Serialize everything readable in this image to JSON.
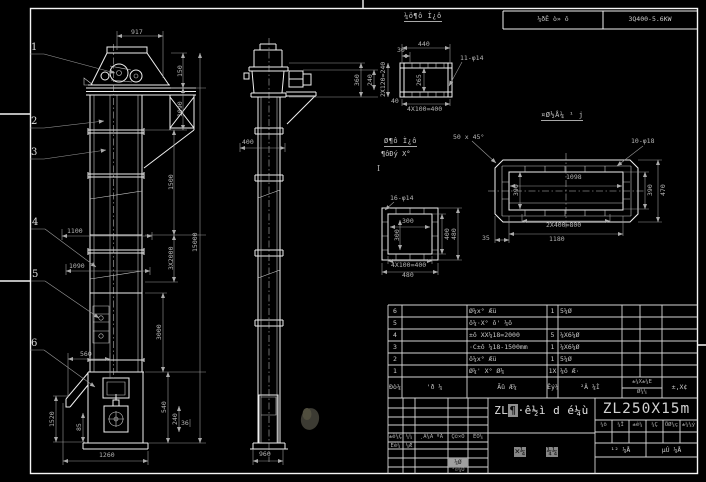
{
  "top_bar": {
    "material_note": "¼ðÊ ò» ô",
    "power_note": "3Q400-5.6KW"
  },
  "front_view": {
    "balloons": [
      "1",
      "2",
      "3",
      "4",
      "5",
      "6"
    ],
    "d917": "917",
    "d150": "150",
    "d1090": "1090",
    "d1500": "1500",
    "d3x2000": "3X2000",
    "d15000": "15000",
    "d3000": "3000",
    "d540": "540",
    "d240": "240",
    "d36": "36",
    "d1100": "1100",
    "d1090b": "1090",
    "d560": "560",
    "d1520": "1520",
    "d85": "85",
    "d1260": "1260"
  },
  "side_view": {
    "d400": "400",
    "d950": "960",
    "d360": "360",
    "d240": "240",
    "mark": "I"
  },
  "details": {
    "channel": {
      "title": "¼ö¶ô Ì¿ô",
      "d440": "440",
      "d30": "30",
      "holes": "11-φ14",
      "d265": "265",
      "dleft": "2X120=240",
      "d40": "40",
      "dbot": "4X100=400"
    },
    "section_note": {
      "line1": "Ø¶ô Ì¿ô",
      "line2": "¶ôÐý X°"
    },
    "square": {
      "holes": "16-φ14",
      "d300h": "300",
      "d300v": "300",
      "dbot1": "4X100=400",
      "dbot2": "480",
      "dr400": "400",
      "dr480": "480"
    },
    "flange": {
      "title": "¤Ø½Å¼ ¹ j",
      "chamfer": "50 x 45°",
      "holes": "10-φ18",
      "d1098": "1098",
      "d390l": "390",
      "dbot1": "2X400=800",
      "dbot2": "1180",
      "d35": "35",
      "d390r": "390",
      "d470": "470"
    }
  },
  "bom": {
    "header": {
      "no": "Ðò¼",
      "code": "'ð ¼",
      "name": "Ãû Æ¼",
      "qty": "Êý¼",
      "mat": "²Ä ¼Ì",
      "wtop": "±¼X±¼E",
      "wbot": "Ø¼¼",
      "rem": "±,X¢"
    },
    "rows": [
      {
        "no": "6",
        "name": "Ø¼x° Æü",
        "qty": "1",
        "mat": "5¼Ø"
      },
      {
        "no": "5",
        "name": "ô¼·X° ô' ¼ô",
        "qty": "",
        "mat": ""
      },
      {
        "no": "4",
        "name": "±ô XX¼18=2000",
        "qty": "5",
        "mat": "¼X6¼Ø"
      },
      {
        "no": "3",
        "name": "·C±ô ¼18-1500mm",
        "qty": "1",
        "mat": "¼X6¼Ø"
      },
      {
        "no": "2",
        "name": "ô¼x° Æü",
        "qty": "1",
        "mat": "5¼Ø"
      },
      {
        "no": "1",
        "name": "Ø¼' X° Ø¼",
        "qty": "1X",
        "mat": "¼ô Æ·"
      }
    ]
  },
  "title_block": {
    "rev_cols": [
      "±ê¼Ç",
      "¼¼",
      "¸Ä¼Ä ºÅ",
      "Ç©×Ö",
      "ÈÕ¼"
    ],
    "design": "Éè¼",
    "design2": "¼Æ",
    "audit": "¼Ø",
    "craft": "¹¤¼Õ",
    "title_prefix": "ZL",
    "title_hl": "¶",
    "title_rest": "·ê½ì d é¼ù",
    "sub1": "×¼",
    "sub2": "¼¼",
    "model": "ZL250X15m",
    "small_cells": [
      "¼ö",
      "¼Î",
      "±ê¼",
      "¼Ç",
      "ÖØ¼ç",
      "±¼¼ý"
    ],
    "sheet_total": "¹² ¼Å",
    "sheet_no": "µÚ ¼Å"
  },
  "colors": {
    "bg": "#000000",
    "line": "#f0f0f0",
    "dim": "#9a9a9a",
    "text": "#c9c9c9"
  }
}
